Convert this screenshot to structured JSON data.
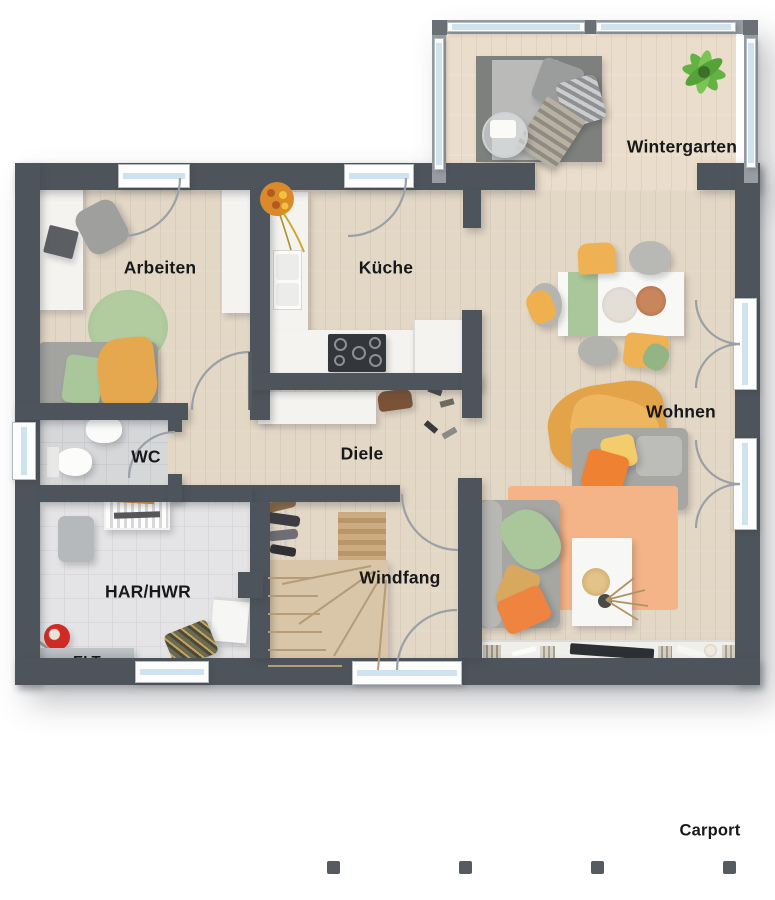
{
  "rooms": {
    "wintergarten": {
      "label": "Wintergarten"
    },
    "arbeiten": {
      "label": "Arbeiten"
    },
    "kueche": {
      "label": "Küche"
    },
    "wohnen": {
      "label": "Wohnen"
    },
    "wc": {
      "label": "WC"
    },
    "diele": {
      "label": "Diele"
    },
    "har_hwr": {
      "label": "HAR/HWR"
    },
    "elt": {
      "label": "ELT"
    },
    "windfang": {
      "label": "Windfang"
    },
    "carport": {
      "label": "Carport"
    }
  },
  "colors": {
    "wall": "#4e545b",
    "wintergarten_wall": "#979ca3",
    "glass": "#cfe3ee",
    "wood_floor": "#e3d7c6",
    "tile_wc": "#d6d7d9",
    "tile_har": "#e4e4e6",
    "label_text": "#17181a",
    "accent_orange": "#ef8132",
    "accent_yellow": "#eeb254",
    "accent_green": "#a9c79b",
    "rug_peach": "#f4b488",
    "sofa_gray": "#a6a6a3",
    "counter_white": "#f4f3f0",
    "stairs_wood": "#d9c6a8"
  }
}
